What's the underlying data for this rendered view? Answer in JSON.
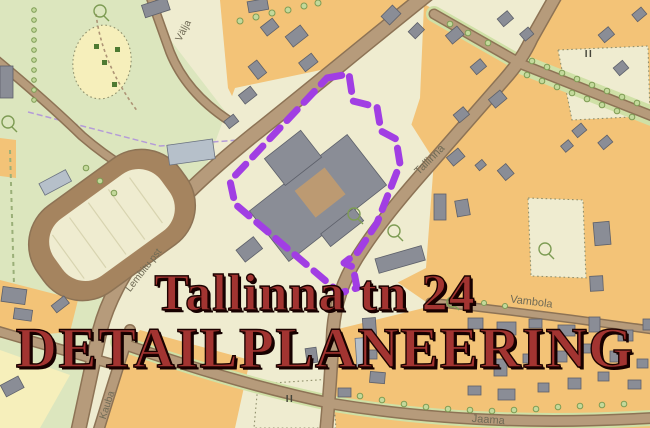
{
  "title": {
    "line1": "Tallinna tn 24",
    "line2": "DETAILPLANEERING"
  },
  "map": {
    "street_labels": [
      {
        "id": "valja",
        "text": "Välja"
      },
      {
        "id": "tallinna",
        "text": "Tallinna"
      },
      {
        "id": "lembitu",
        "text": "Lembitu pst"
      },
      {
        "id": "kauba",
        "text": "Kauba"
      },
      {
        "id": "vambola",
        "text": "Vambola"
      },
      {
        "id": "jaama",
        "text": "Jaama"
      }
    ],
    "annotations": [
      {
        "id": "storeys-northeast",
        "text": "II"
      },
      {
        "id": "storeys-south",
        "text": "II"
      }
    ]
  },
  "colors": {
    "boundary-purple": "#a13ee3",
    "title-red": "#a23431",
    "title-outline": "#1c0200",
    "map-orange": "#f3c377",
    "map-green": "#dce6be",
    "map-cream": "#efecd0",
    "road-tan": "#b69b7b",
    "building-gray": "#8a8d96"
  }
}
